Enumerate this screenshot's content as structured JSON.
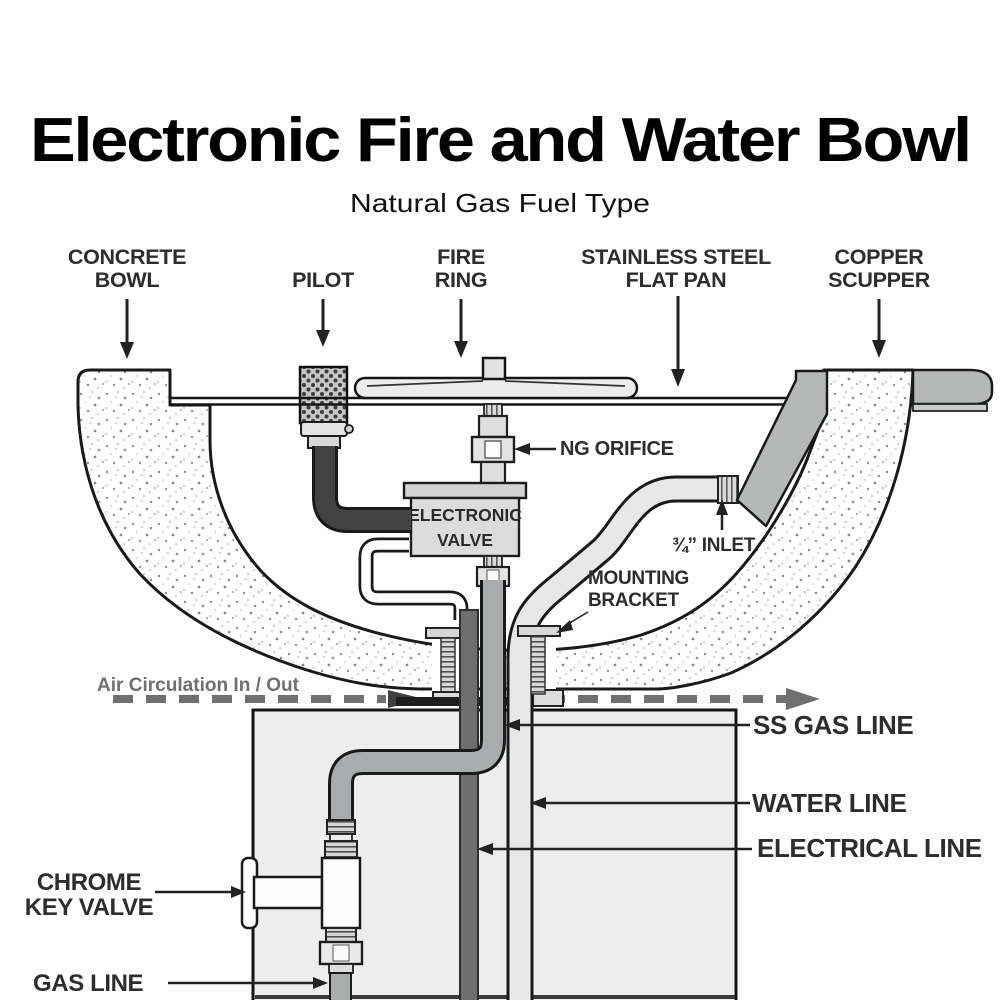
{
  "title": "Electronic Fire and Water Bowl",
  "subtitle": "Natural Gas Fuel Type",
  "labels": {
    "concrete_bowl": {
      "line1": "CONCRETE",
      "line2": "BOWL"
    },
    "pilot": "PILOT",
    "fire_ring": {
      "line1": "FIRE",
      "line2": "RING"
    },
    "flat_pan": {
      "line1": "STAINLESS STEEL",
      "line2": "FLAT PAN"
    },
    "copper_scupper": {
      "line1": "COPPER",
      "line2": "SCUPPER"
    },
    "ng_orifice": "NG ORIFICE",
    "electronic_valve": {
      "line1": "ELECTRONIC",
      "line2": "VALVE"
    },
    "inlet": "¾” INLET",
    "mounting_bracket": {
      "line1": "MOUNTING",
      "line2": "BRACKET"
    },
    "air_circulation": "Air Circulation In / Out",
    "ss_gas_line": "SS GAS LINE",
    "water_line": "WATER LINE",
    "electrical_line": "ELECTRICAL LINE",
    "chrome_key_valve": {
      "line1": "CHROME",
      "line2": "KEY VALVE"
    },
    "gas_line": "GAS LINE"
  },
  "colors": {
    "outline": "#1a1a1a",
    "label_text": "#2d2d2d",
    "metal_gray": "#b5b8b7",
    "pipe_gray": "#a9acac",
    "electrical_dark": "#6e6e6e",
    "pedestal_fill": "#ecedec",
    "air_gray": "#6f6f6f"
  }
}
